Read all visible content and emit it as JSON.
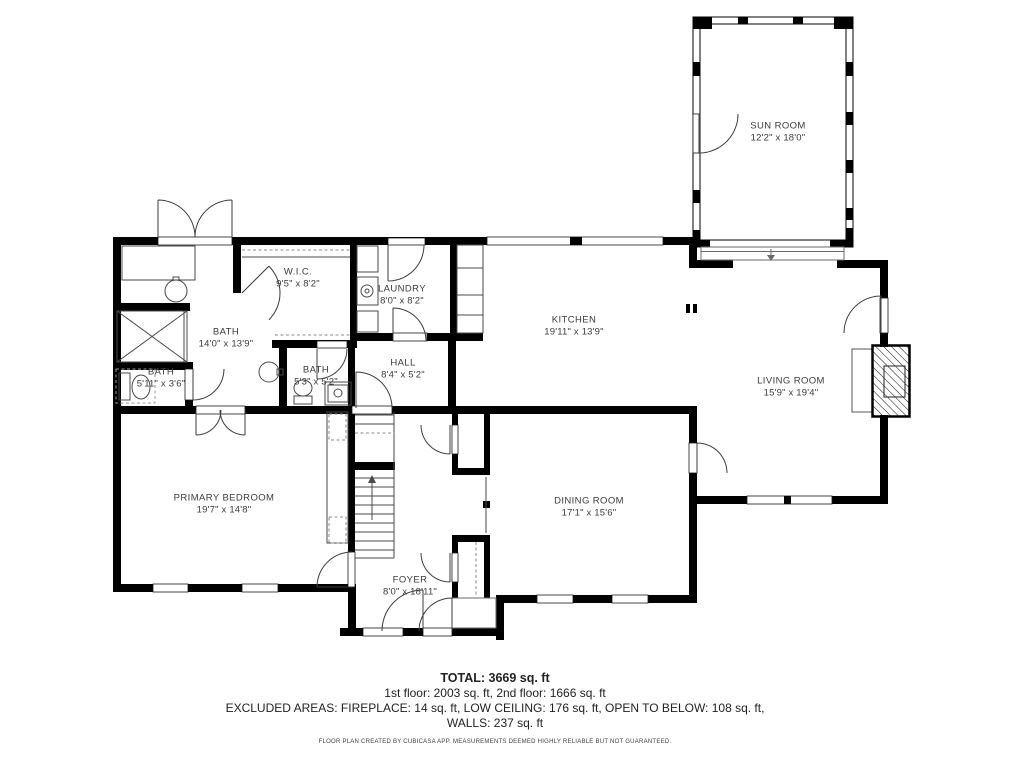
{
  "plan": {
    "rooms": [
      {
        "name": "SUN ROOM",
        "dims": "12'2\" x 18'0\""
      },
      {
        "name": "W.I.C.",
        "dims": "9'5\" x 8'2\""
      },
      {
        "name": "LAUNDRY",
        "dims": "8'0\" x 8'2\""
      },
      {
        "name": "KITCHEN",
        "dims": "19'11\" x 13'9\""
      },
      {
        "name": "BATH",
        "dims": "14'0\" x 13'9\""
      },
      {
        "name": "BATH",
        "dims": "5'11\" x 3'6\""
      },
      {
        "name": "BATH",
        "dims": "5'3\" x 5'2\""
      },
      {
        "name": "HALL",
        "dims": "8'4\" x 5'2\""
      },
      {
        "name": "LIVING ROOM",
        "dims": "15'9\" x 19'4\""
      },
      {
        "name": "PRIMARY BEDROOM",
        "dims": "19'7\" x 14'8\""
      },
      {
        "name": "DINING ROOM",
        "dims": "17'1\" x 15'6\""
      },
      {
        "name": "FOYER",
        "dims": "8'0\" x 18'11\""
      }
    ],
    "summary": {
      "total": "TOTAL: 3669 sq. ft",
      "floors": "1st floor: 2003 sq. ft, 2nd floor: 1666 sq. ft",
      "excluded": "EXCLUDED AREAS: FIREPLACE: 14 sq. ft, LOW CEILING: 176 sq. ft, OPEN TO BELOW: 108 sq. ft,",
      "walls": "WALLS: 237 sq. ft"
    },
    "footer": "FLOOR PLAN CREATED BY CUBICASA APP. MEASUREMENTS DEEMED HIGHLY RELIABLE BUT NOT GUARANTEED.",
    "colors": {
      "wall": "#000000",
      "label": "#3b3b3b",
      "background": "#ffffff"
    }
  }
}
